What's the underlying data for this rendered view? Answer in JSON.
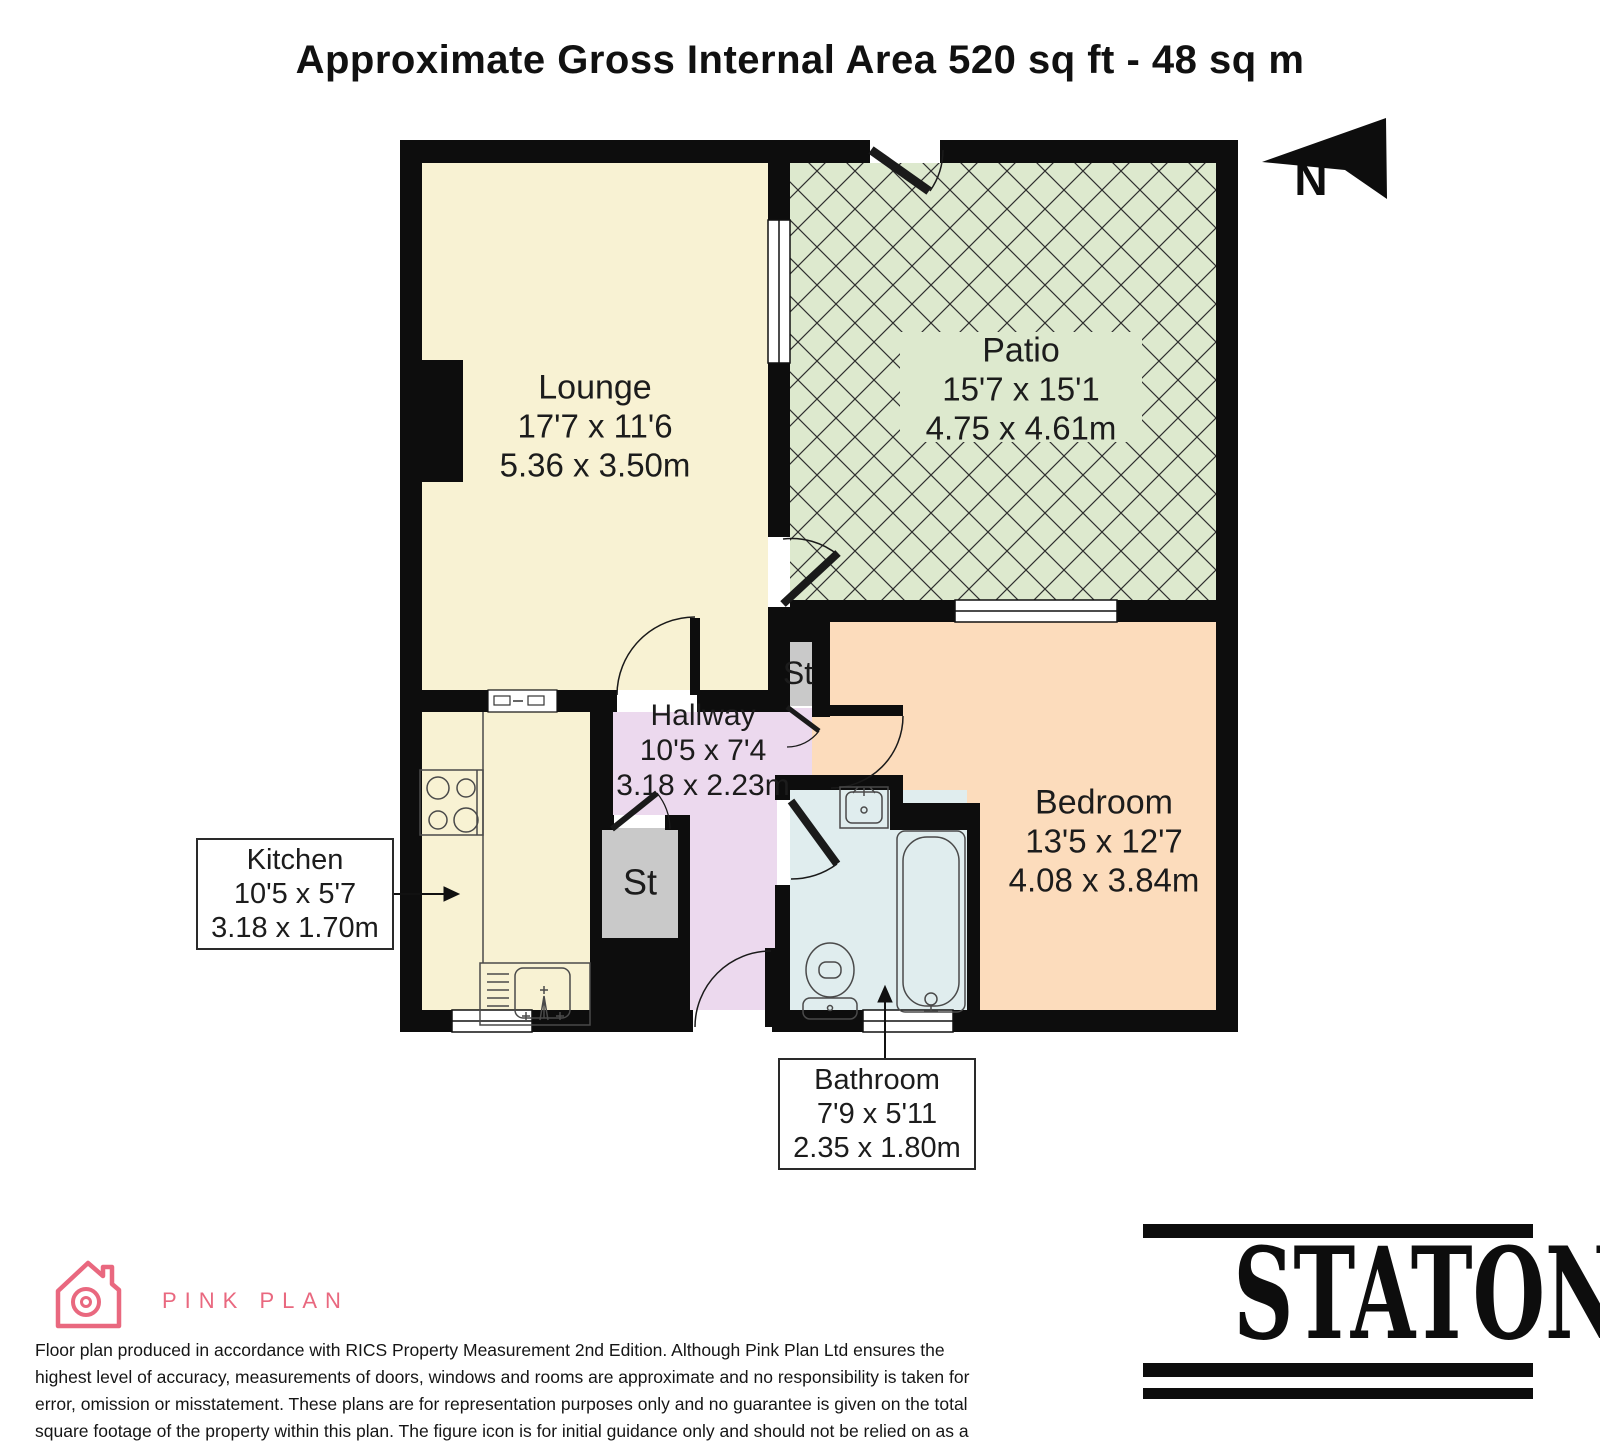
{
  "header": {
    "title": "Approximate Gross Internal Area 520 sq ft - 48 sq m"
  },
  "compass": {
    "label": "N"
  },
  "rooms": {
    "lounge": {
      "name": "Lounge",
      "dims_imperial": "17'7 x 11'6",
      "dims_metric": "5.36 x 3.50m"
    },
    "patio": {
      "name": "Patio",
      "dims_imperial": "15'7 x 15'1",
      "dims_metric": "4.75 x 4.61m"
    },
    "hallway": {
      "name": "Hallway",
      "dims_imperial": "10'5 x 7'4",
      "dims_metric": "3.18 x 2.23m"
    },
    "kitchen": {
      "name": "Kitchen",
      "dims_imperial": "10'5 x 5'7",
      "dims_metric": "3.18 x 1.70m"
    },
    "bedroom": {
      "name": "Bedroom",
      "dims_imperial": "13'5 x 12'7",
      "dims_metric": "4.08 x 3.84m"
    },
    "bathroom": {
      "name": "Bathroom",
      "dims_imperial": "7'9 x 5'11",
      "dims_metric": "2.35 x 1.80m"
    },
    "storage_label": "St"
  },
  "branding": {
    "producer_name": "PINK PLAN",
    "agency_name": "STATONS"
  },
  "disclaimer": "Floor plan produced in accordance with RICS Property Measurement 2nd Edition. Although Pink Plan Ltd ensures the highest level of accuracy, measurements of doors, windows and rooms are approximate and no responsibility is taken for error, omission or misstatement. These plans are for representation purposes only and no guarantee is given on the total square footage of the property within this plan. The figure icon is for initial guidance only and should not be relied on as a basis of valuation.",
  "colors": {
    "wall": "#0d0d0d",
    "room_cream": "#f8f2d3",
    "patio_green": "#dde9ce",
    "hallway_lilac": "#ecd9ee",
    "bedroom_peach": "#fcdcbc",
    "bathroom_blue": "#e0edee",
    "storage_gray": "#c9c9c9",
    "brand_pink": "#e9687f",
    "line_dark": "#111111"
  }
}
